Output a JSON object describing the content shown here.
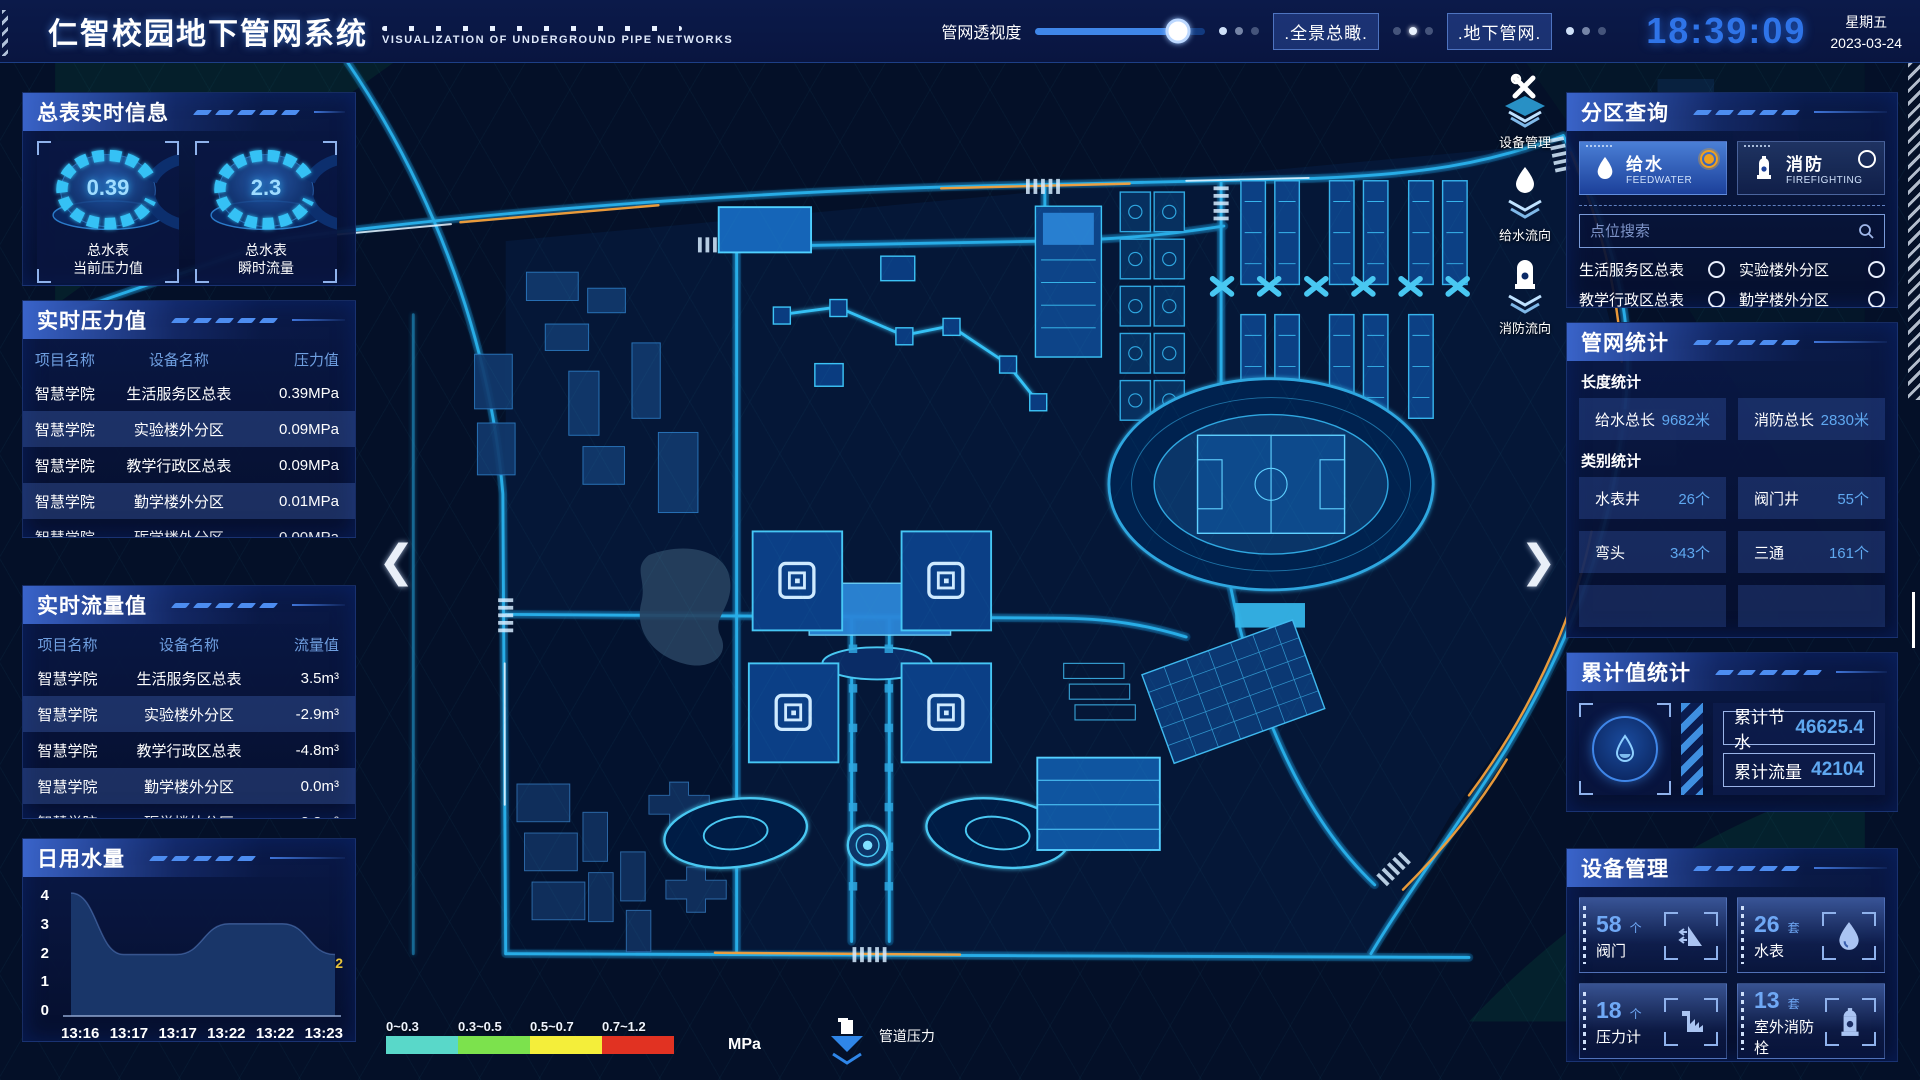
{
  "header": {
    "title": "仁智校园地下管网系统",
    "subtitle": "VISUALIZATION OF UNDERGROUND PIPE NETWORKS",
    "slider_label": "管网透视度",
    "btn_overview": ".全景总瞰.",
    "btn_underground": ".地下管网.",
    "clock": "18:39:09",
    "weekday": "星期五",
    "date": "2023-03-24"
  },
  "left": {
    "meter_panel": {
      "title": "总表实时信息",
      "gauges": [
        {
          "value": "0.39",
          "label1": "总水表",
          "label2": "当前压力值"
        },
        {
          "value": "2.3",
          "label1": "总水表",
          "label2": "瞬时流量"
        }
      ]
    },
    "pressure_panel": {
      "title": "实时压力值",
      "headers": [
        "项目名称",
        "设备名称",
        "压力值"
      ],
      "rows": [
        [
          "智慧学院",
          "生活服务区总表",
          "0.39MPa"
        ],
        [
          "智慧学院",
          "实验楼外分区",
          "0.09MPa"
        ],
        [
          "智慧学院",
          "教学行政区总表",
          "0.09MPa"
        ],
        [
          "智慧学院",
          "勤学楼外分区",
          "0.01MPa"
        ],
        [
          "智慧学院",
          "砺学楼外分区",
          "0.00MPa"
        ]
      ]
    },
    "flow_panel": {
      "title": "实时流量值",
      "headers": [
        "项目名称",
        "设备名称",
        "流量值"
      ],
      "rows": [
        [
          "智慧学院",
          "生活服务区总表",
          "3.5m³"
        ],
        [
          "智慧学院",
          "实验楼外分区",
          "-2.9m³"
        ],
        [
          "智慧学院",
          "教学行政区总表",
          "-4.8m³"
        ],
        [
          "智慧学院",
          "勤学楼外分区",
          "0.0m³"
        ],
        [
          "智慧学院",
          "砺学楼外分区",
          "2.3m³"
        ]
      ]
    },
    "daily_panel": {
      "title": "日用水量",
      "end_label": "2"
    }
  },
  "chart_data": {
    "type": "area",
    "title": "日用水量",
    "x": [
      "13:16",
      "13:17",
      "13:17",
      "13:22",
      "13:22",
      "13:23"
    ],
    "values": [
      4,
      2,
      2,
      3,
      3,
      2
    ],
    "ylim": [
      0,
      4
    ],
    "yticks": [
      0,
      1,
      2,
      3,
      4
    ],
    "xlabel": "",
    "ylabel": "",
    "end_point_label": "2"
  },
  "right": {
    "zone_panel": {
      "title": "分区查询",
      "feed": {
        "name": "给水",
        "sub": "FEEDWATER"
      },
      "fire": {
        "name": "消防",
        "sub": "FIREFIGHTING"
      },
      "search_placeholder": "点位搜索",
      "items": [
        "生活服务区总表",
        "实验楼外分区",
        "教学行政区总表",
        "勤学楼外分区",
        "砺学楼外分区",
        "宿舍区泵房"
      ]
    },
    "network_panel": {
      "title": "管网统计",
      "len_label": "长度统计",
      "len_stats": [
        {
          "name": "给水总长",
          "value": "9682米"
        },
        {
          "name": "消防总长",
          "value": "2830米"
        }
      ],
      "cat_label": "类别统计",
      "cat_stats": [
        {
          "name": "水表井",
          "value": "26个"
        },
        {
          "name": "阀门井",
          "value": "55个"
        },
        {
          "name": "弯头",
          "value": "343个"
        },
        {
          "name": "三通",
          "value": "161个"
        }
      ]
    },
    "total_panel": {
      "title": "累计值统计",
      "rows": [
        {
          "name": "累计节水",
          "value": "46625.4"
        },
        {
          "name": "累计流量",
          "value": "42104"
        }
      ]
    },
    "device_panel": {
      "title": "设备管理",
      "cards": [
        {
          "count": "58",
          "unit": "个",
          "name": "阀门"
        },
        {
          "count": "26",
          "unit": "套",
          "name": "水表"
        },
        {
          "count": "18",
          "unit": "个",
          "name": "压力计"
        },
        {
          "count": "13",
          "unit": "套",
          "name": "室外消防栓"
        }
      ]
    }
  },
  "map_overlay": {
    "tools": [
      {
        "label": "设备管理"
      },
      {
        "label": "给水流向"
      },
      {
        "label": "消防流向"
      }
    ],
    "legend": {
      "ranges": [
        "0~0.3",
        "0.3~0.5",
        "0.5~0.7",
        "0.7~1.2"
      ],
      "colors": [
        "#59d8c9",
        "#7ce24d",
        "#f4ee3a",
        "#e13222"
      ],
      "unit": "MPa",
      "pressure_label": "管道压力"
    }
  }
}
